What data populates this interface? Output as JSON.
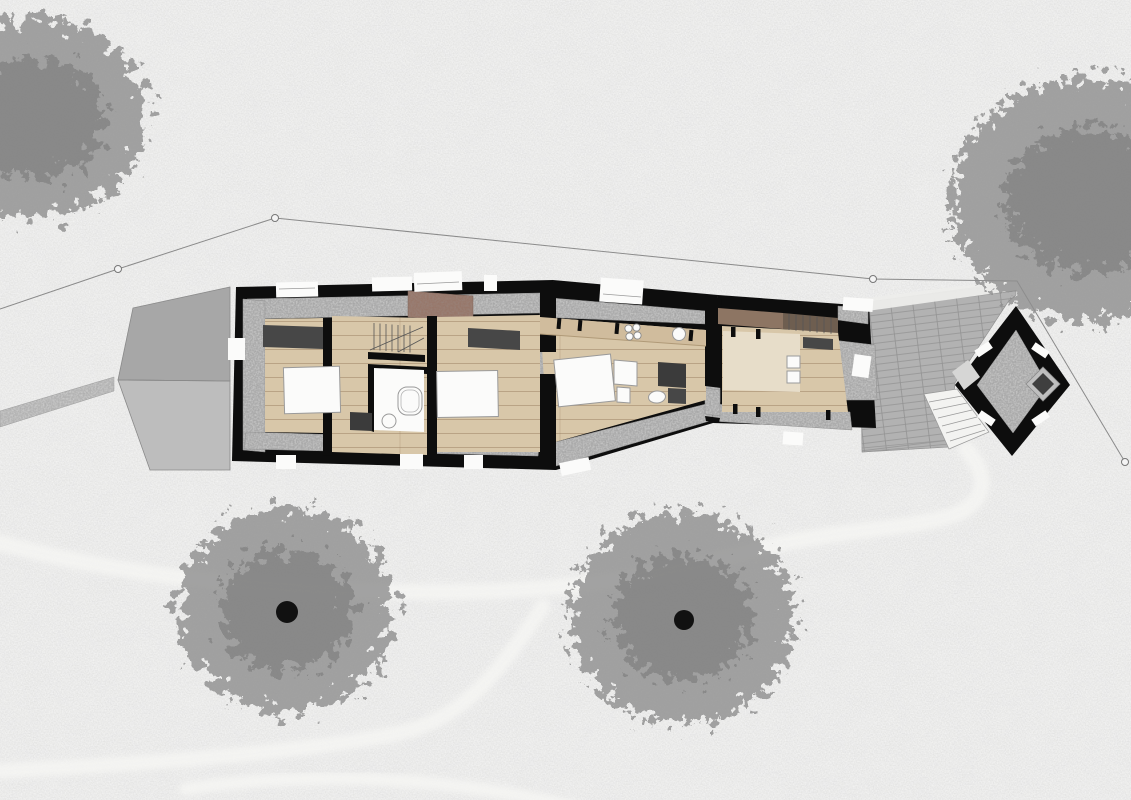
{
  "document": {
    "type": "architectural site plan",
    "view": "top-down ground floor plan of an elongated stone house with annex, east terrace and diamond-shaped tower pavilion, set in a field with four trees and worn grass trails",
    "visible_text": []
  },
  "colors": {
    "bg": "#e4e4e3",
    "bg-speck": "#fbfbfa",
    "wall": "#0d0d0d",
    "stone": "#ababab",
    "wood": "#d8c7a9",
    "wood-line": "#927858",
    "counter": "#d0bc9d",
    "rug": "#e7ddc9",
    "white": "#fbfbfa",
    "fixture-line": "#9a9a9a",
    "dark-furniture": "#474747",
    "charcoal": "#3b3b3b",
    "brown-masonry": "#97776a",
    "landing-brown": "#8d7563",
    "stair-brown": "#6e5e50",
    "annex-north": "#a7a7a7",
    "annex-south": "#bdbdbd",
    "terrace": "#b2b2b2",
    "trail": "#f5f5f3",
    "boundary": "#8a8a8a",
    "tree": "#8d8d8d",
    "tree-dark": "#747474",
    "trunk": "#111111",
    "steps": "#f3f3f1",
    "fireplace-outer": "#bfbfbf",
    "fireplace-inner": "#3f3f3f"
  },
  "site": {
    "boundary_polyline": "0,309 118,269 275,218 873,279 1017,281 1125,462",
    "survey_points": [
      {
        "x": 118,
        "y": 269
      },
      {
        "x": 275,
        "y": 218
      },
      {
        "x": 873,
        "y": 279
      },
      {
        "x": 1125,
        "y": 462
      }
    ],
    "trails": [
      {
        "d": "M 0,543 C 120,575 260,591 420,592 C 560,593 640,580 760,549 C 840,528 900,531 950,516 C 985,505 992,478 966,449",
        "width": 16
      },
      {
        "d": "M 0,771 C 140,764 290,754 395,734 C 465,720 500,670 543,606",
        "width": 15
      },
      {
        "d": "M 186,789 C 320,769 460,779 578,808",
        "width": 13
      }
    ],
    "trees": [
      {
        "cx": 35,
        "cy": 118,
        "rx": 112,
        "ry": 100,
        "trunk": null
      },
      {
        "cx": 1090,
        "cy": 200,
        "rx": 140,
        "ry": 122,
        "trunk": null
      },
      {
        "cx": 286,
        "cy": 610,
        "rx": 108,
        "ry": 102,
        "trunk": {
          "x": 287,
          "y": 612,
          "r": 11
        }
      },
      {
        "cx": 682,
        "cy": 618,
        "rx": 112,
        "ry": 106,
        "trunk": {
          "x": 684,
          "y": 620,
          "r": 10
        }
      }
    ]
  },
  "building": {
    "features": [
      "west annex with hipped grey roof",
      "west block: two bedrooms, stair, bathroom with tub",
      "middle block: kitchen counter with hob and sink, bed, shower room",
      "east block: living room with stair and bench",
      "stone terrace with steps",
      "diamond tower pavilion with corner fireplace"
    ]
  }
}
